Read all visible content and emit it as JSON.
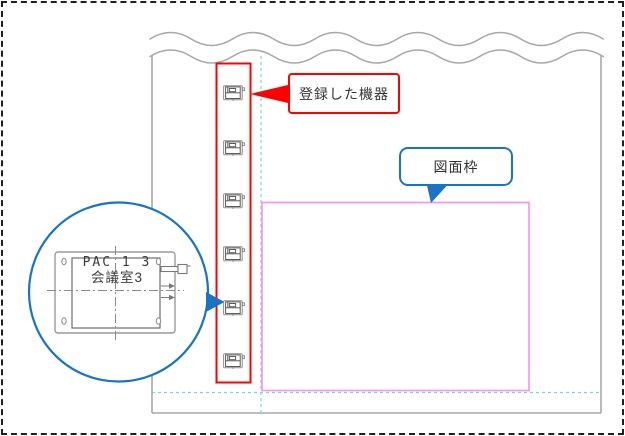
{
  "figure": {
    "annotations": {
      "registered_equipment_label": "登録した機器",
      "drawing_frame_label": "図面枠"
    },
    "magnifier": {
      "equipment_tag": "PAC 1 3",
      "room_name": "会議室3"
    },
    "equipment_units": [
      {
        "y": 93
      },
      {
        "y": 148
      },
      {
        "y": 201
      },
      {
        "y": 254
      },
      {
        "y": 308
      },
      {
        "y": 361
      }
    ],
    "colors": {
      "annotation_red": "#ff0000",
      "annotation_blue": "#1a74c4",
      "frame_pink": "#fb8cf8",
      "guide_cyan": "#76d8d8",
      "drawing_gray": "#a8a8a8"
    }
  }
}
